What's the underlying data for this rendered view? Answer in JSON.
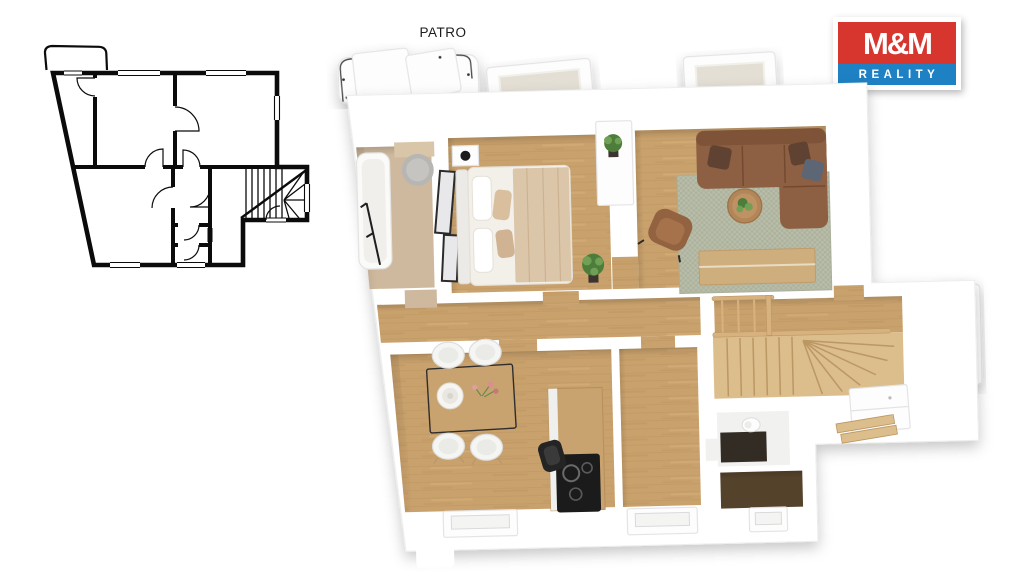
{
  "page": {
    "background": "#ffffff"
  },
  "header": {
    "plan_label": "PATRO"
  },
  "logo": {
    "brand": "M&M Reality",
    "line1": "M&M",
    "line2": "REALITY"
  },
  "plans": {
    "plan2d": "2d-floor-plan-outline",
    "plan3d": "3d-rendered-floor-plan",
    "rooms": [
      "balcony",
      "bathroom",
      "bedroom",
      "living-room",
      "hallway",
      "kitchen-dining",
      "middle-room",
      "staircase",
      "wc",
      "storage-room"
    ],
    "furniture": [
      "bathtub",
      "shower-rug",
      "mirror-frames",
      "double-bed",
      "nightstand-lamp",
      "dresser",
      "potted-plant",
      "corner-sofa",
      "coffee-table",
      "armchair",
      "area-rug",
      "sideboard",
      "dining-table",
      "dining-chairs",
      "vase",
      "kitchen-counter",
      "cooktop",
      "bar-chair",
      "toilet",
      "stair-railing",
      "cabinet"
    ]
  },
  "colors": {
    "logo-red": "#d6362e",
    "logo-blue": "#1e81c4",
    "ink": "#0b0b0b",
    "wall-line": "#e9eaec",
    "wood": "#c9a16c",
    "wood-dark": "#ad8553",
    "wood-light": "#d8b27e",
    "stair-wood": "#dcbd8c",
    "stair-line": "#bb9763",
    "bath-floor": "#cfb99e",
    "dark-floor": "#332c25",
    "brown-floor": "#55422b",
    "glass": "#e4dfd5",
    "rug": "#b8bda9",
    "rug-dark": "#a8ae99",
    "sofa": "#8d5f43",
    "sofa-dark": "#72492f",
    "pillow-brown": "#5f4232",
    "pillow-gray": "#5d6674",
    "armchair": "#966845",
    "table-wood": "#c9a36f",
    "cooktop": "#1b1b1b",
    "chair-white": "#f5f5f3",
    "bed-linen": "#f3f0ea",
    "blanket": "#dcc6aa",
    "plant": "#4d7d3a",
    "plant-light": "#6fa055"
  }
}
